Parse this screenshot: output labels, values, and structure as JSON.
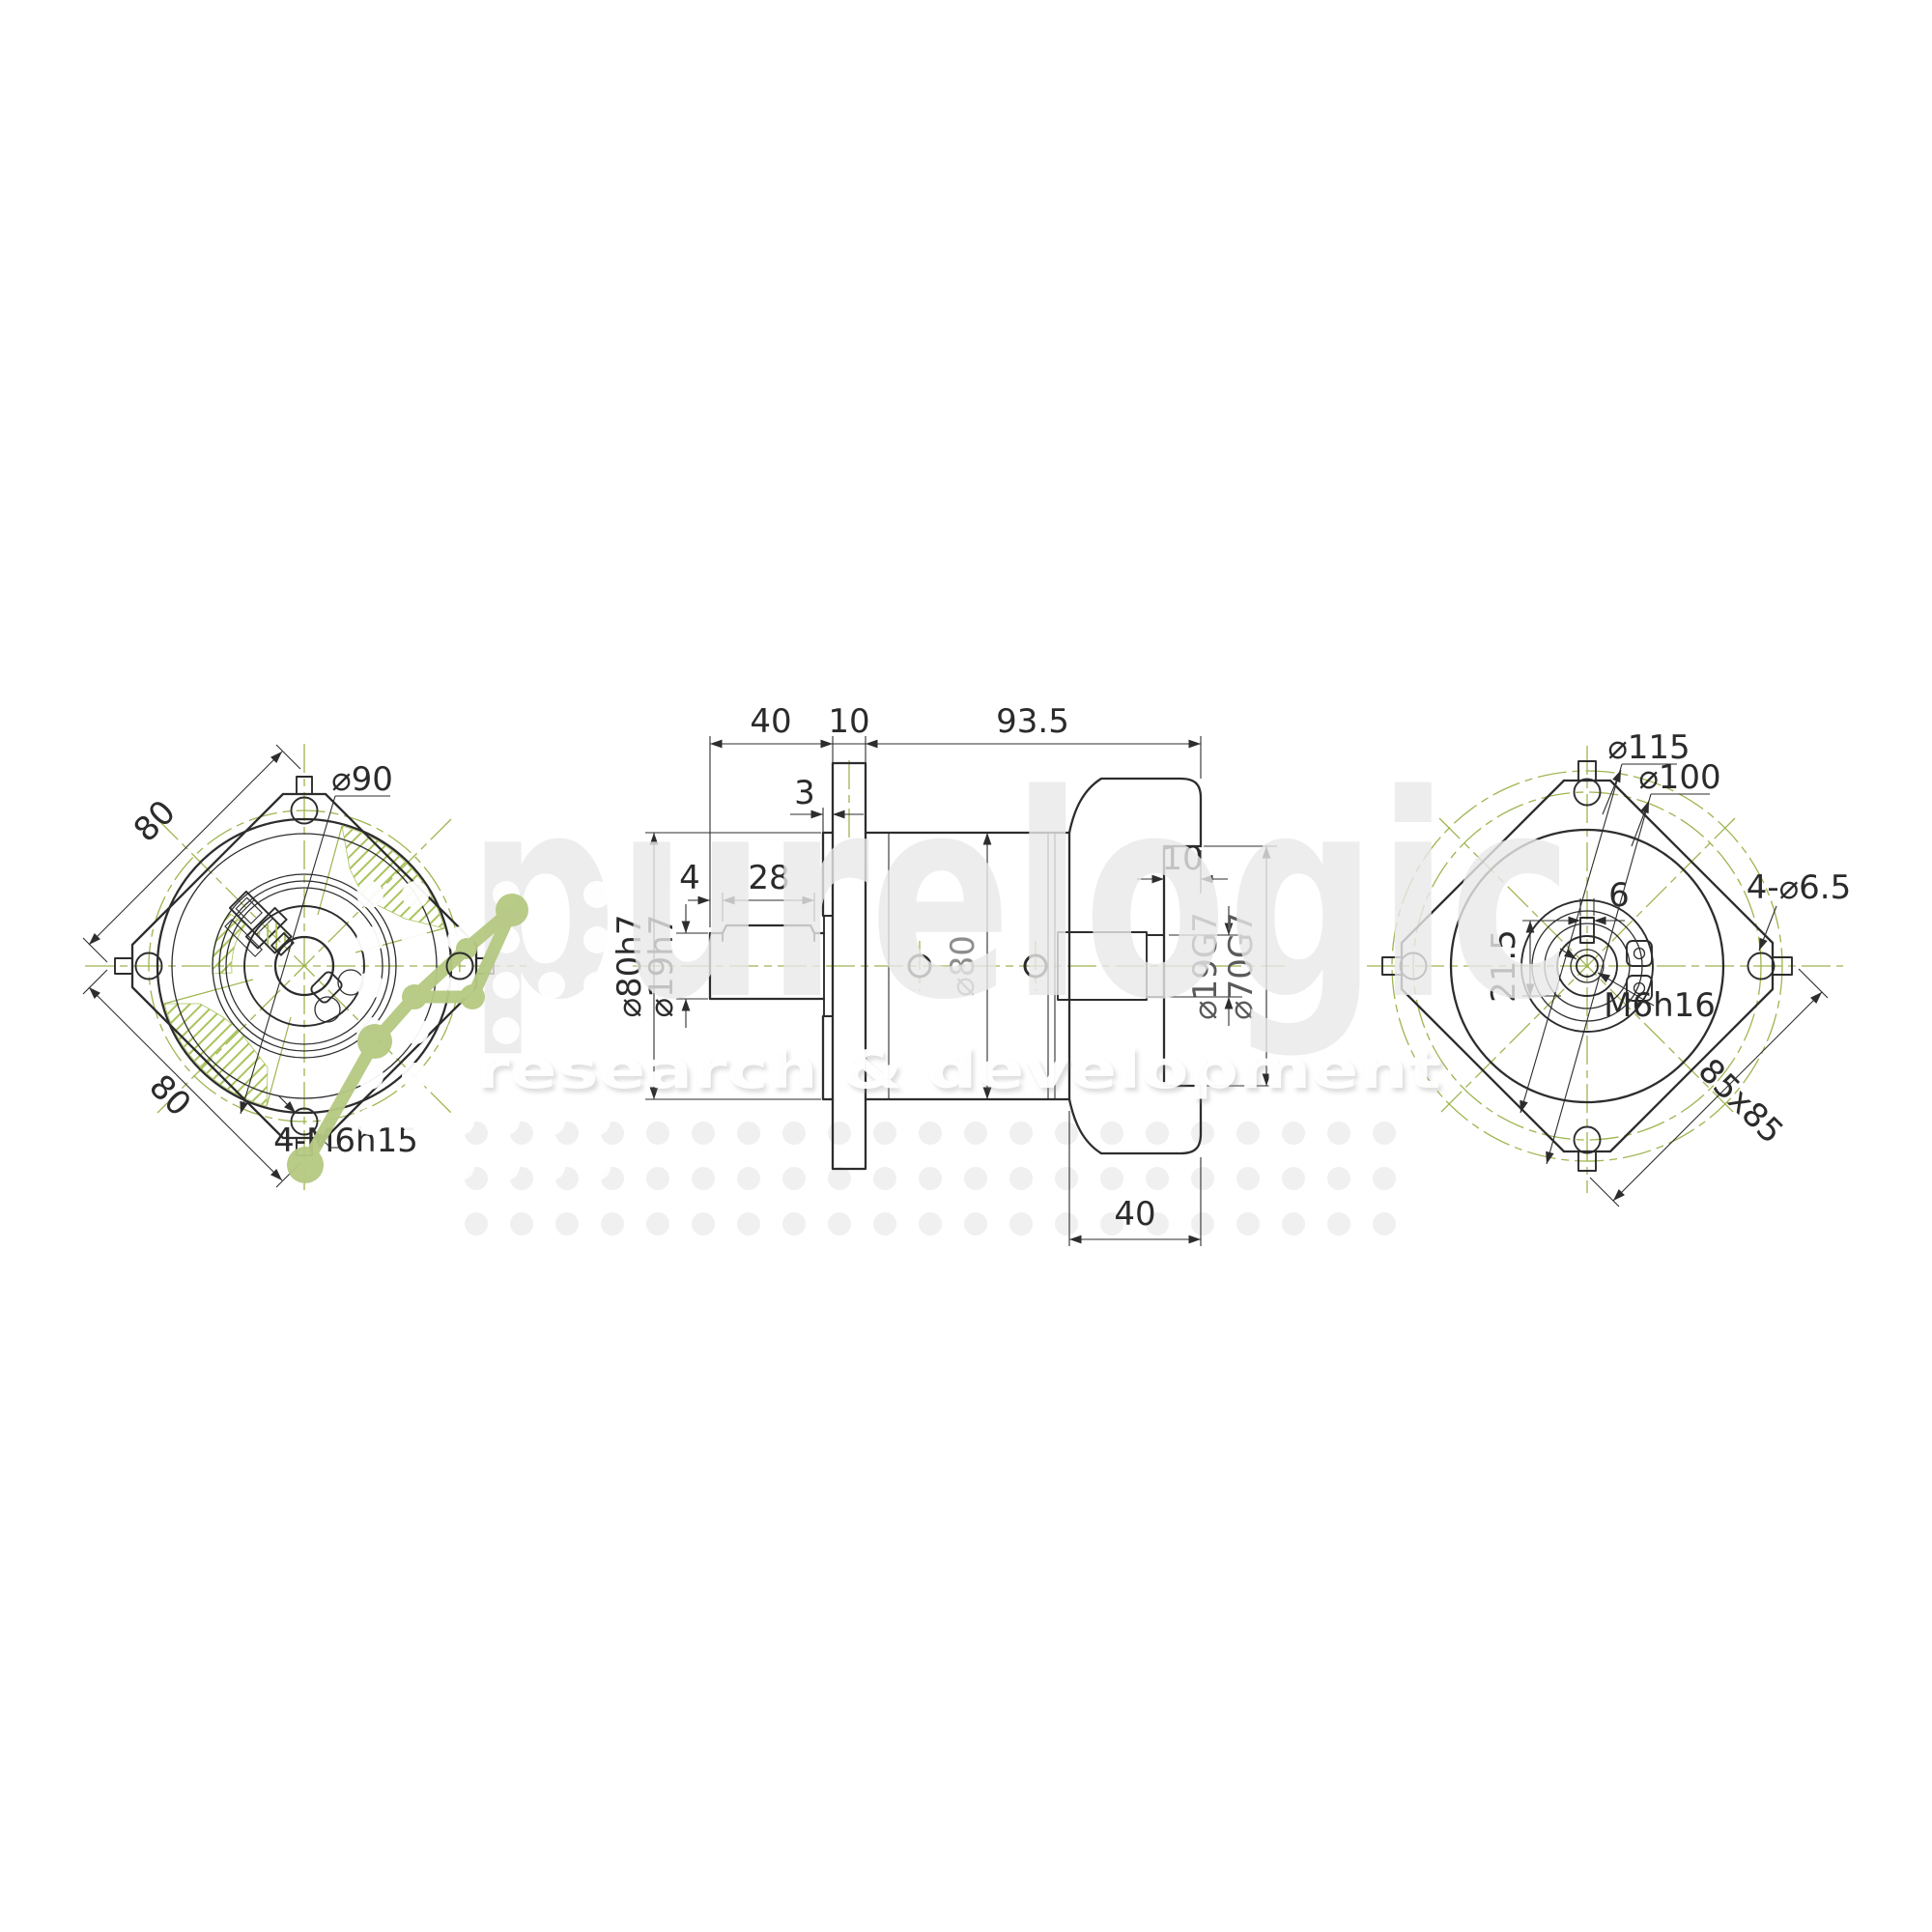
{
  "drawing": {
    "left_view": {
      "square_top": "80",
      "square_bottom": "80",
      "bolt_circle": "⌀90",
      "thread_callout": "4-M6h15"
    },
    "side_view": {
      "shaft_length": "40",
      "flange_thickness": "10",
      "body_length": "93.5",
      "pilot_step": "3",
      "key_offset": "4",
      "key_length": "28",
      "pilot_dia": "⌀80h7",
      "shaft_dia": "⌀19h7",
      "body_dia": "⌀80",
      "recess_depth": "10",
      "bore_dia": "⌀19G7",
      "recess_dia": "⌀70G7",
      "bell_length": "40"
    },
    "right_view": {
      "outer_dia": "⌀115",
      "bolt_circle": "⌀100",
      "hole_callout": "4-⌀6.5",
      "key_width": "6",
      "key_depth": "21.5",
      "screw_callout": "M6h16",
      "flange_square": "85x85"
    }
  },
  "watermark": {
    "brand": "purelogic",
    "tagline": "research & development"
  },
  "colors": {
    "line": "#2d2d2d",
    "centerline": "#9db54f",
    "hatch": "#a9c45c",
    "logo": "#b6c983"
  }
}
